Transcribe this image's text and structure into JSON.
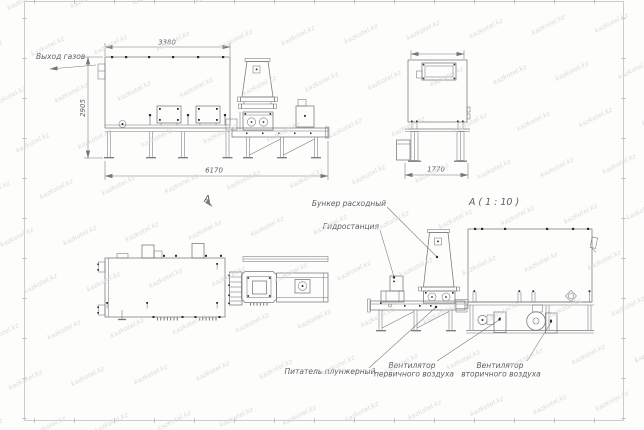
{
  "watermark": {
    "text": "kazkotel.kz"
  },
  "colors": {
    "line": "#74787a",
    "accent": "#2a2b2b",
    "text": "#5c6063",
    "frame": "#c3c7c6",
    "watermark": "#d7dad8",
    "background": "#fdfdfc"
  },
  "views": {
    "side": {
      "label": "А",
      "dim_width_top": "3380",
      "dim_height": "2905",
      "dim_length": "6170",
      "gas_outlet": "Выход газов"
    },
    "end": {
      "dim_width": "1770"
    },
    "detail": {
      "title": "А ( 1 : 10 )"
    },
    "callouts": {
      "hopper": "Бункер расходный",
      "hydraulic": "Гидростанция",
      "feeder": "Питатель плунжерный",
      "fan_primary_1": "Вентилятор",
      "fan_primary_2": "первичного воздуха",
      "fan_secondary_1": "Вентилятор",
      "fan_secondary_2": "вторичного воздуха"
    }
  }
}
